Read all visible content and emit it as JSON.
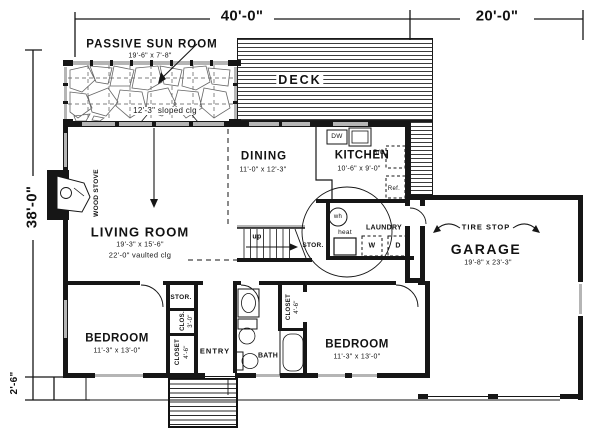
{
  "drawing": {
    "dimensions": {
      "width_main": "40'-0\"",
      "width_garage": "20'-0\"",
      "depth_main": "38'-0\"",
      "front_offset": "2'-6\""
    },
    "rooms": {
      "sunroom": {
        "name": "PASSIVE SUN ROOM",
        "size": "19'-6\" x 7'-8\"",
        "ceiling": "12'-3\" sloped clg"
      },
      "deck": {
        "name": "DECK"
      },
      "dining": {
        "name": "DINING",
        "size": "11'-0\" x 12'-3\""
      },
      "kitchen": {
        "name": "KITCHEN",
        "size": "10'-6\" x 9'-0\""
      },
      "living": {
        "name": "LIVING ROOM",
        "size": "19'-3\" x 15'-6\"",
        "ceiling": "22'-0\" vaulted clg"
      },
      "garage": {
        "name": "GARAGE",
        "size": "19'-8\" x 23'-3\"",
        "note": "TIRE STOP"
      },
      "bedroom_left": {
        "name": "BEDROOM",
        "size": "11'-3\" x 13'-0\""
      },
      "bedroom_right": {
        "name": "BEDROOM",
        "size": "11'-3\" x 13'-0\""
      },
      "bath": {
        "name": "BATH"
      },
      "entry": {
        "name": "ENTRY"
      },
      "laundry": {
        "name": "LAUNDRY",
        "washer": "W",
        "dryer": "D"
      }
    },
    "fixtures": {
      "wood_stove": "WOOD STOVE",
      "dishwasher": "DW",
      "range_oven": "R/O",
      "refrigerator": "Ref.",
      "water_heater": "wh",
      "furnace": "heat",
      "stairs_direction": "up",
      "stair_storage": "STOR.",
      "hall_storage": "STOR.",
      "closet_small": {
        "name": "CLOS.",
        "size": "3'-0\""
      },
      "closet_entry": {
        "name": "CLOSET",
        "size": "4'-6\""
      },
      "closet_bedroom": {
        "name": "CLOSET",
        "size": "4'-6\""
      }
    },
    "colors": {
      "ink": "#161616",
      "paper": "#ffffff",
      "glass": "#b5b5b5"
    }
  }
}
